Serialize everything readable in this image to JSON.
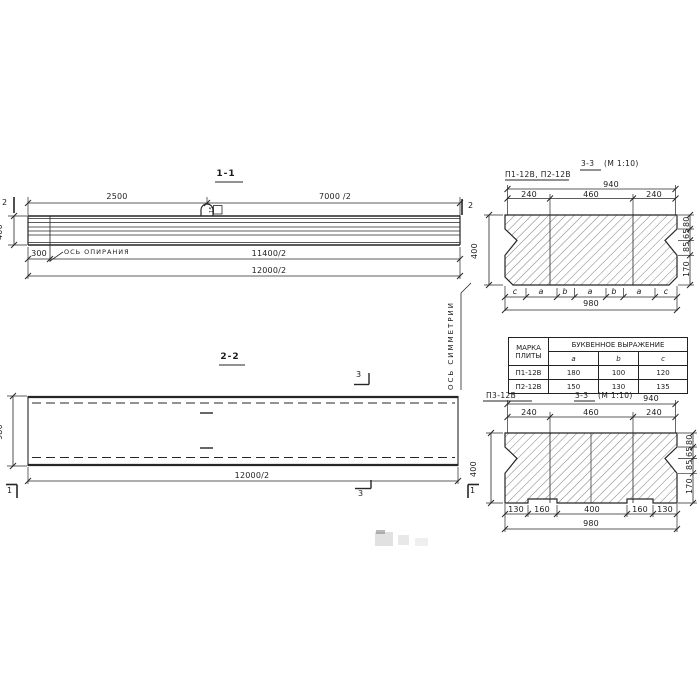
{
  "section_1_1": {
    "title": "1-1",
    "dim_2500": "2500",
    "dim_7000_half": "7000 /2",
    "dim_400": "400",
    "dim_300": "300",
    "dim_11400_half": "11400/2",
    "dim_12000_half": "12000/2",
    "support_axis_label": "ОСЬ ОПИРАНИЯ",
    "cut_mark": "2",
    "loop_tag": "15"
  },
  "section_2_2": {
    "title": "2-2",
    "dim_980": "980",
    "dim_12000_half": "12000/2",
    "cut_mark_1": "1",
    "cut_mark_3": "3",
    "symmetry_axis_label": "ОСЬ СИММЕТРИИ"
  },
  "cross_top": {
    "plate_marks": "П1-12В, П2-12В",
    "title_section": "3-3",
    "title_scale": "(М 1:10)",
    "dim_940": "940",
    "dim_240_left": "240",
    "dim_460": "460",
    "dim_240_right": "240",
    "right_dims": [
      "80",
      "65",
      "85",
      "170"
    ],
    "bottom_letters": [
      "c",
      "a",
      "b",
      "a",
      "b",
      "a",
      "c"
    ],
    "dim_980": "980",
    "dim_400": "400"
  },
  "cross_bottom": {
    "plate_mark": "П3-12В",
    "title_section": "3-3",
    "title_scale": "(М 1:10)",
    "dim_940": "940",
    "dim_240_left": "240",
    "dim_460": "460",
    "dim_240_right": "240",
    "right_dims": [
      "80",
      "65",
      "85",
      "170"
    ],
    "bottom_dims": [
      "130",
      "160",
      "400",
      "160",
      "130"
    ],
    "dim_980": "980",
    "dim_400": "400"
  },
  "table": {
    "header_mark_line1": "МАРКА",
    "header_mark_line2": "ПЛИТЫ",
    "header_letters": "БУКВЕННОЕ  ВЫРАЖЕНИЕ",
    "col_a": "a",
    "col_b": "b",
    "col_c": "c",
    "rows": [
      {
        "mark": "П1-12В",
        "a": "180",
        "b": "100",
        "c": "120"
      },
      {
        "mark": "П2-12В",
        "a": "150",
        "b": "130",
        "c": "135"
      }
    ]
  }
}
